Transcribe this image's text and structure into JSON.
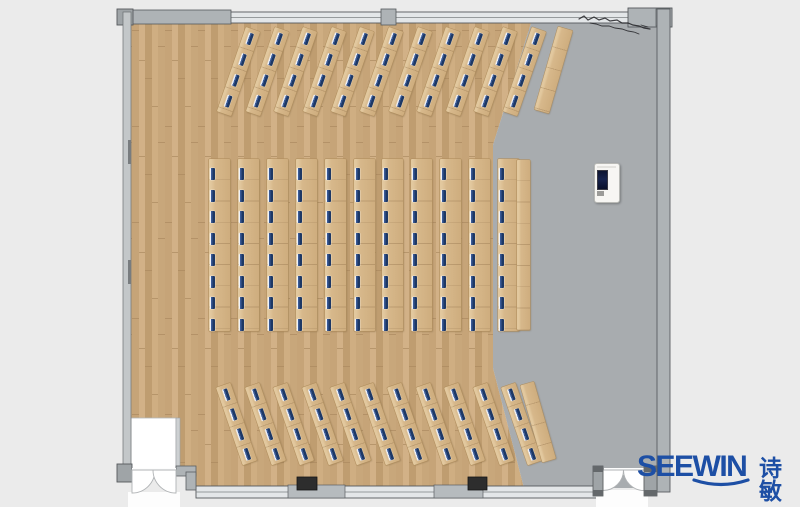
{
  "branding": {
    "logo_latin": "SEEWIN",
    "logo_cjk": "诗敏",
    "logo_color": "#1d4fa5"
  },
  "palette": {
    "canvas_bg": "#ebebeb",
    "wood_p1": "#c6a478",
    "wood_p2": "#d2b187",
    "wood_p3": "#bf9d70",
    "wood_p4": "#cfae82",
    "wood_p5": "#c8a77b",
    "wood_joint": "#a9885e",
    "gray_floor": "#a8acaf",
    "window_fill": "#e3e6e8",
    "wall_fill": "#aeb3b6",
    "wall_fill_light": "#c3c7c9",
    "wall_dark": "#55595c",
    "desk_light": "#e2c89e",
    "desk_mid": "#d7b88b",
    "desk_dark": "#cfae7f",
    "desk_edge": "#b2905f",
    "seat_navy": "#1d3865",
    "seat_mid": "#3a5a96",
    "seat_hi": "#eef2fa",
    "door_white": "#fdfdfd",
    "column_dark": "#2d2d2d",
    "scribble": "#26262a",
    "podium_body": "#f7f6f3",
    "podium_screen": "#17234c",
    "logo_blue": "#1d4fa5"
  },
  "layout_stats": {
    "front_angled_rows": 11,
    "front_seats_per_row": 4,
    "middle_straight_rows": 11,
    "middle_seats_per_row": 8,
    "rear_angled_rows": 11,
    "rear_seats_per_row": 4,
    "empty_side_rows": 3,
    "total_seats": 176
  },
  "desk_sections": [
    {
      "name": "front-angled-rows",
      "angle": 19,
      "count": 11,
      "first_left": 231,
      "spacing": 28.6,
      "top": 27,
      "w": 15,
      "h": 89,
      "seat_x": 5,
      "seat_ys": [
        4,
        26,
        48,
        70
      ],
      "blank": {
        "left": 546,
        "top": 27,
        "w": 15,
        "h": 86,
        "angle": 16
      }
    },
    {
      "name": "middle-straight-rows",
      "angle": 0,
      "count": 11,
      "first_left": 209,
      "spacing": 28.9,
      "top": 159,
      "w": 21,
      "h": 172,
      "seat_x": 1,
      "seat_ys": [
        9,
        30.5,
        52,
        73.5,
        95,
        116.5,
        138,
        159.5
      ],
      "blank": {
        "left": 517,
        "top": 160,
        "w": 13,
        "h": 170,
        "angle": 0
      }
    },
    {
      "name": "rear-angled-rows",
      "angle": -19,
      "count": 11,
      "first_left": 229,
      "spacing": 28.5,
      "top": 383,
      "w": 15,
      "h": 82,
      "seat_x": 5,
      "seat_ys": [
        4,
        25,
        46,
        67
      ],
      "blank": {
        "left": 531,
        "top": 382,
        "w": 14,
        "h": 80,
        "angle": -16
      }
    }
  ]
}
